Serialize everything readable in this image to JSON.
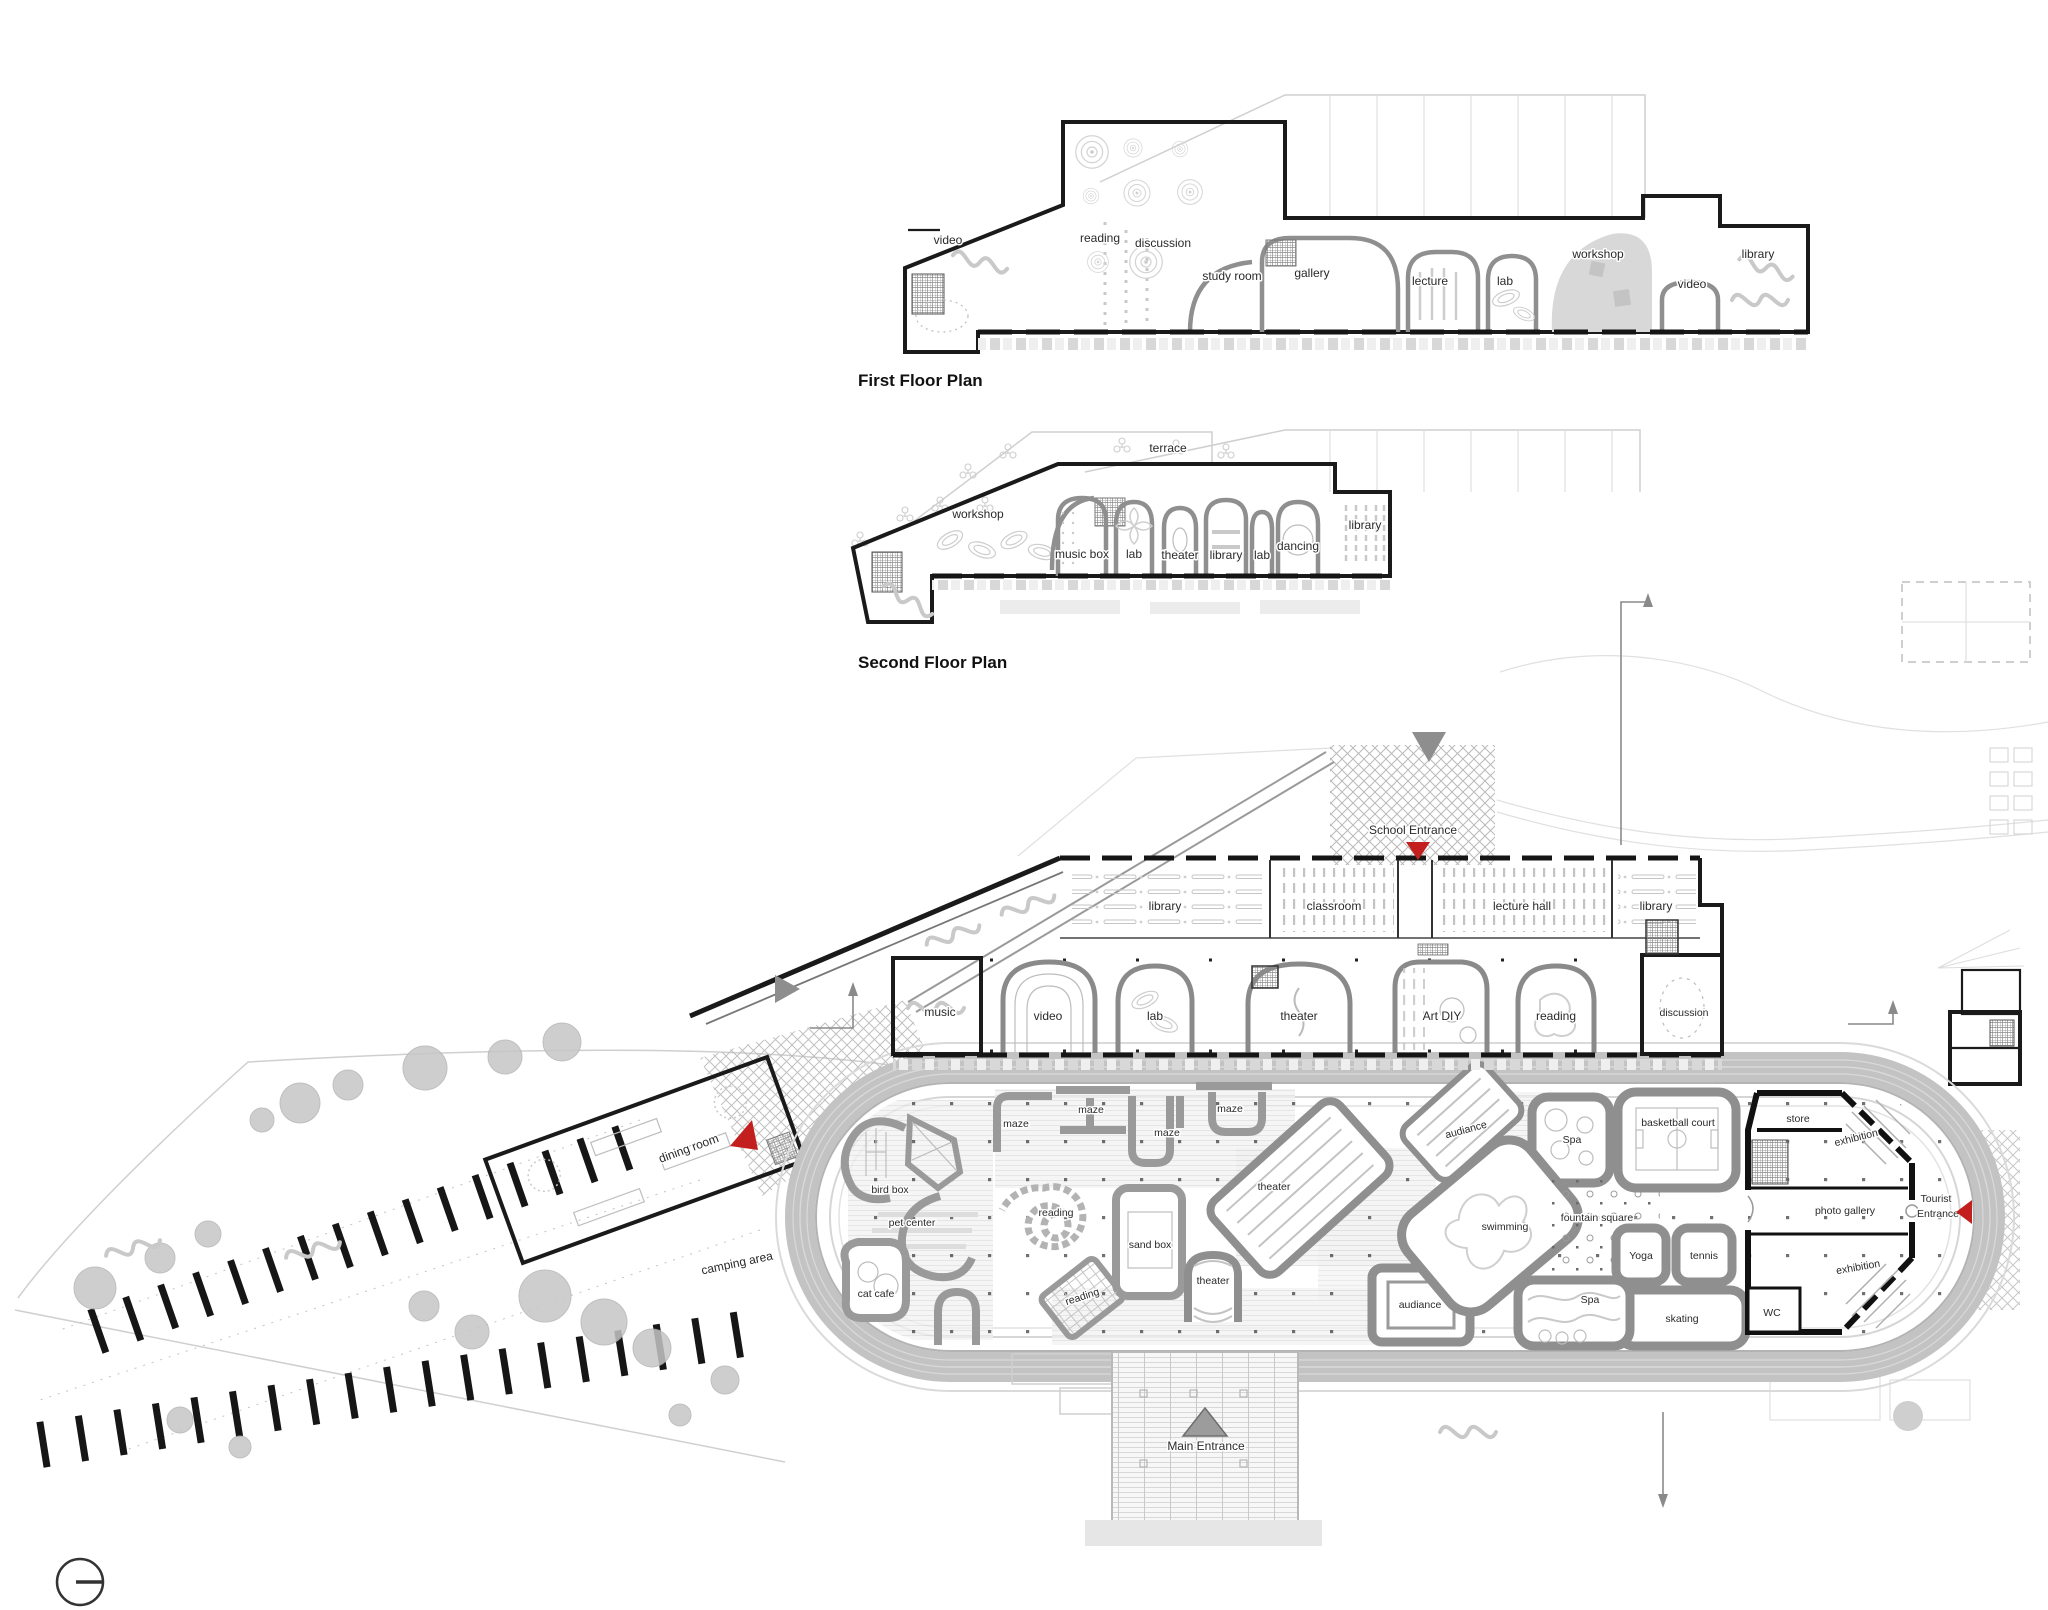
{
  "colors": {
    "wall_black": "#1a1a1a",
    "room_gray": "#8f8f8f",
    "track_gray": "#c2c2c2",
    "light_gray": "#d6d6d6",
    "accent_red": "#c41f1f",
    "marker_gray": "#8e8e8e",
    "text": "#2a2a2a"
  },
  "plans": {
    "first": {
      "caption": "First Floor Plan",
      "rooms": [
        "video",
        "reading",
        "discussion",
        "study room",
        "gallery",
        "lecture",
        "lab",
        "workshop",
        "video",
        "library"
      ]
    },
    "second": {
      "caption": "Second Floor Plan",
      "rooms": [
        "terrace",
        "workshop",
        "music box",
        "lab",
        "theater",
        "library",
        "lab",
        "dancing",
        "library"
      ]
    }
  },
  "site": {
    "school": {
      "entrance": "School Entrance",
      "upper": [
        "library",
        "classroom",
        "lecture hall",
        "library"
      ],
      "activity": [
        "music",
        "video",
        "lab",
        "theater",
        "Art DIY",
        "reading",
        "discussion"
      ]
    },
    "play": {
      "maze1": "maze",
      "maze2": "maze",
      "maze3": "maze",
      "maze4": "maze",
      "bird_box": "bird box",
      "pet_center": "pet center",
      "cat_cafe": "cat cafe",
      "reading_spiral": "reading",
      "reading_deck": "reading",
      "sand_box": "sand box",
      "theater_large": "theater",
      "theater_small": "theater",
      "audience_upper": "audiance",
      "audience_lower": "audiance",
      "spa_upper": "Spa",
      "spa_lower": "Spa",
      "basketball": "basketball court",
      "fountain": "fountain square",
      "swimming": "swimming",
      "yoga": "Yoga",
      "tennis": "tennis",
      "skating": "skating"
    },
    "gallery": {
      "store": "store",
      "exhibition_upper": "exhibition",
      "photo_gallery": "photo gallery",
      "exhibition_lower": "exhibition",
      "wc": "WC"
    },
    "tourist": {
      "line1": "Tourist",
      "line2": "Entrance"
    },
    "main_entrance": "Main Entrance",
    "west": {
      "dining": "dining room",
      "camping": "camping area"
    }
  }
}
